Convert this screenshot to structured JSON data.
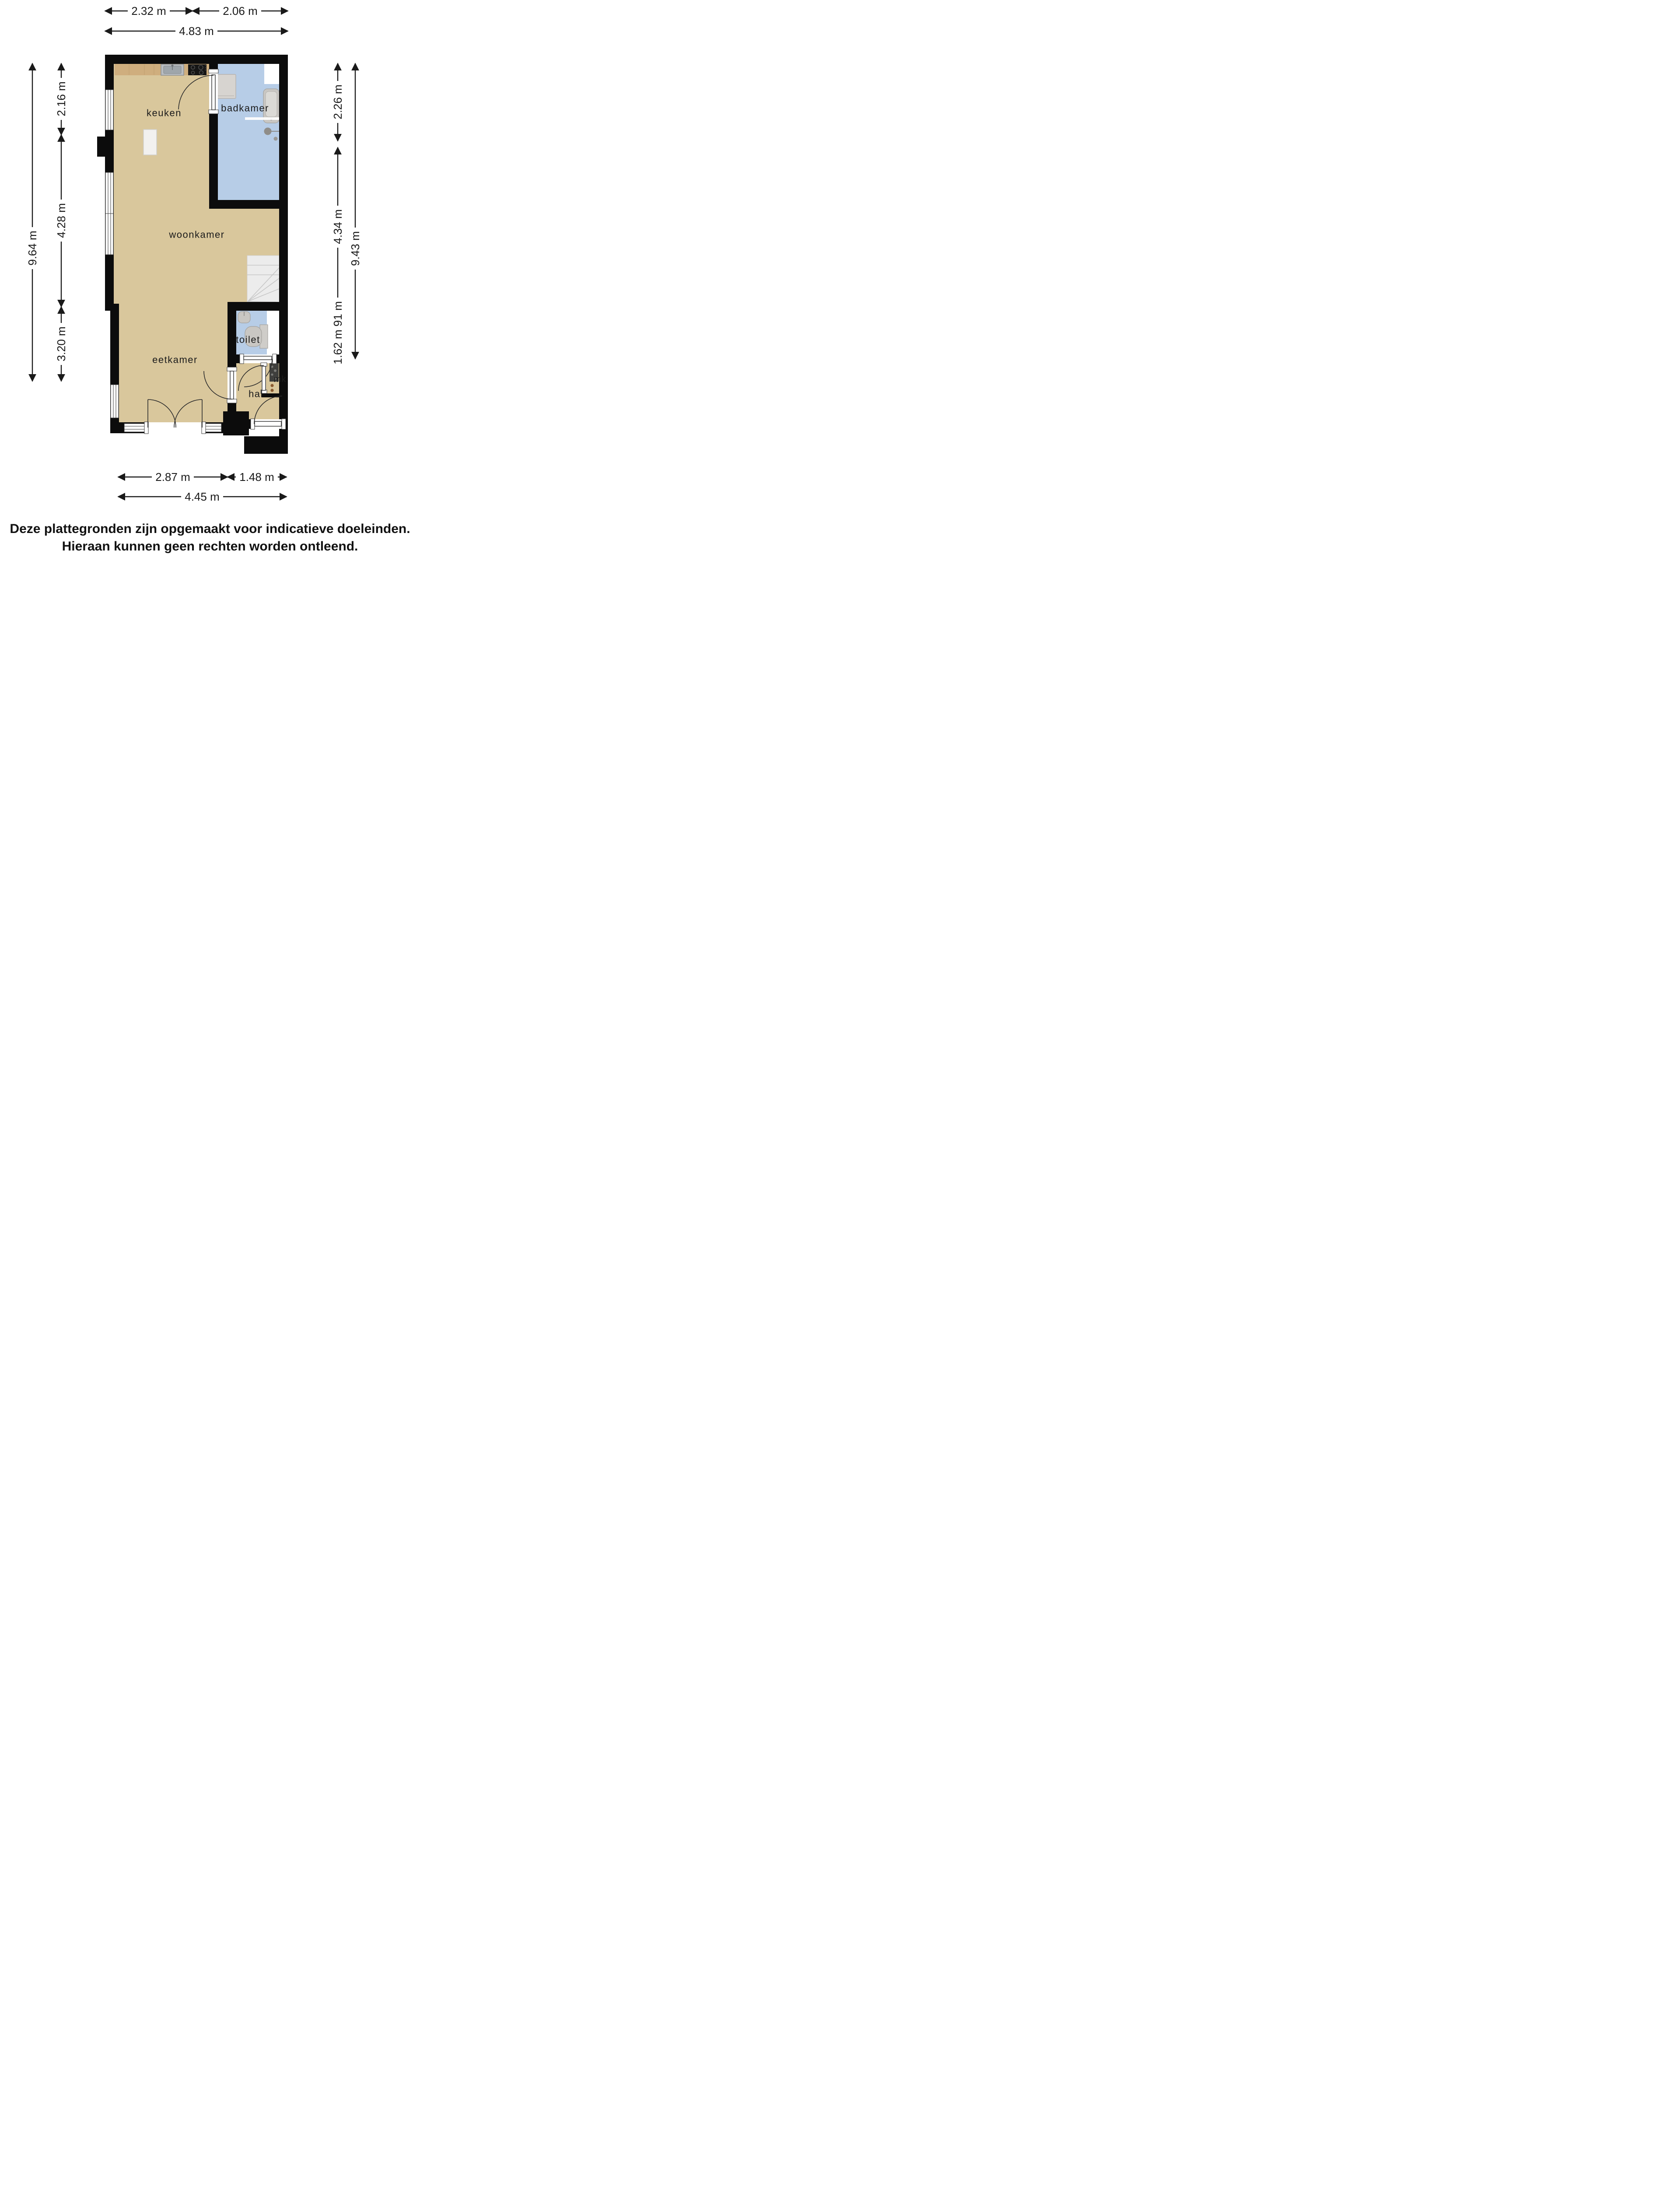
{
  "rooms": {
    "keuken": {
      "label": "keuken"
    },
    "badkamer": {
      "label": "badkamer"
    },
    "woonkamer": {
      "label": "woonkamer"
    },
    "toilet": {
      "label": "toilet"
    },
    "eetkamer": {
      "label": "eetkamer"
    },
    "hal": {
      "label": "hal"
    },
    "mk": {
      "label": "mk"
    }
  },
  "dimensions": {
    "top": {
      "segments": [
        {
          "label": "2.32 m"
        },
        {
          "label": "2.06 m"
        }
      ],
      "total": {
        "label": "4.83 m"
      }
    },
    "left": {
      "segments": [
        {
          "label": "2.16 m"
        },
        {
          "label": "4.28 m"
        },
        {
          "label": "3.20 m"
        }
      ],
      "total": {
        "label": "9.64 m"
      }
    },
    "right": {
      "segments": [
        {
          "label": "2.26 m"
        },
        {
          "label": "4.34 m"
        },
        {
          "label": "0.91 m"
        },
        {
          "label": "1.62 m"
        }
      ],
      "total": {
        "label": "9.43 m"
      }
    },
    "bottom": {
      "segments": [
        {
          "label": "2.87 m"
        },
        {
          "label": "1.48 m"
        }
      ],
      "total": {
        "label": "4.45 m"
      }
    }
  },
  "footer": {
    "line1": "Deze plattegronden zijn opgemaakt voor indicatieve doeleinden.",
    "line2": "Hieraan kunnen geen rechten worden ontleend."
  },
  "colors": {
    "wall": "#0c0c0c",
    "floor": "#d9c79c",
    "wet_floor": "#b7cde7",
    "counter": "#cfae7e",
    "stairs": "#ececec",
    "fixture": "#c9c7c3",
    "meter_panel": "#3f3f3d",
    "socket": "#8a5a2f",
    "dim": "#1a1a1a"
  }
}
